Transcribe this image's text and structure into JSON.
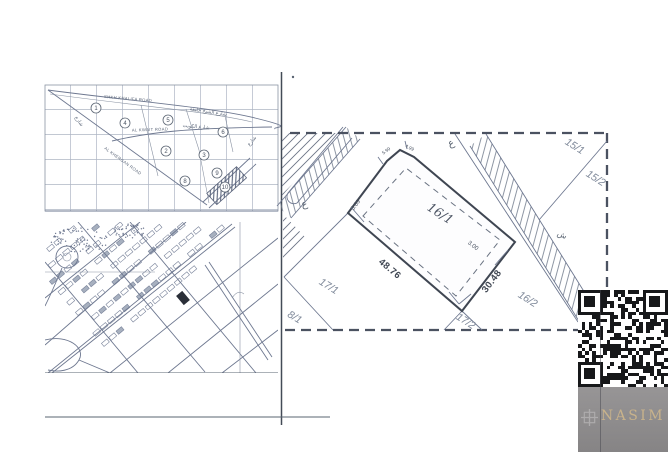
{
  "page": {
    "background": "#ffffff"
  },
  "overview_map": {
    "road_labels": {
      "khalifa": "SHKH KHALIFA ROAD",
      "khalifa_ar": "شارع الشيخ خليفة",
      "kwait": "AL KWAIT ROAD",
      "kwait_ar": "شارع الكويت",
      "khergan": "AL KHERGAN ROAD",
      "side_ar": "شارع"
    },
    "plot_numbers": [
      "1",
      "4",
      "5",
      "6",
      "2",
      "3",
      "8",
      "9",
      "10"
    ]
  },
  "site_plan": {
    "parcel": {
      "label": "16/1",
      "side_long": "48.76",
      "side_short": "30.48",
      "offset_left": "3.89",
      "offset_right": "3.00",
      "corner_a": "5.99",
      "corner_b": "4.99"
    },
    "neighbors": {
      "n15_1": "15/1",
      "n15_2": "15/2",
      "n16_2": "16/2",
      "n17_1": "17/1",
      "n17_2": "17/2",
      "n8_1": "8/1"
    },
    "street_letter": "ع",
    "street_letter_2": "ش"
  },
  "branding": {
    "company": "NASIM"
  }
}
